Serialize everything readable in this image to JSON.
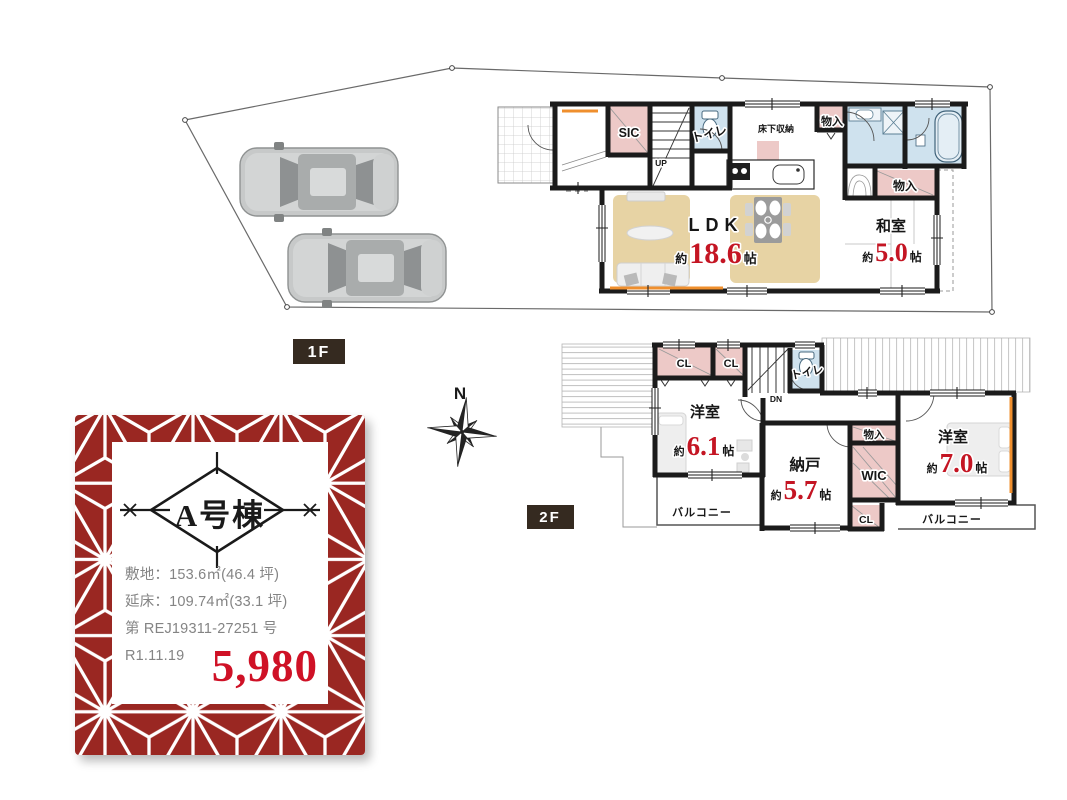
{
  "colors": {
    "wall_black": "#1b1b1b",
    "closet_pink": "#edc9c7",
    "wet_blue": "#cfe2ee",
    "floor_tan": "#e7d3a4",
    "number_red": "#c41523",
    "card_red": "#9a2722",
    "price_red": "#cf1126",
    "tag_brown": "#352a20",
    "accent_orange": "#ef8f2e"
  },
  "compass": {
    "north": "N"
  },
  "floor1": {
    "tag": "1F",
    "ldk": {
      "name": "LDK",
      "approx": "約",
      "size": "18.6",
      "unit": "帖"
    },
    "washitsu": {
      "name": "和室",
      "approx": "約",
      "size": "5.0",
      "unit": "帖"
    },
    "sic": "SIC",
    "toilet": "トイレ",
    "underfloor": "床下収納",
    "closet_a": "物入",
    "closet_b": "物入",
    "stairs": "UP"
  },
  "floor2": {
    "tag": "2F",
    "bedroom1": {
      "name": "洋室",
      "approx": "約",
      "size": "6.1",
      "unit": "帖"
    },
    "storage": {
      "name": "納戸",
      "approx": "約",
      "size": "5.7",
      "unit": "帖"
    },
    "bedroom2": {
      "name": "洋室",
      "approx": "約",
      "size": "7.0",
      "unit": "帖"
    },
    "cl1": "CL",
    "cl2": "CL",
    "cl3": "CL",
    "toilet": "トイレ",
    "closet": "物入",
    "wic": "WIC",
    "balcony_left": "バルコニー",
    "balcony_right": "バルコニー",
    "stairs": "DN"
  },
  "card": {
    "title": "A号棟",
    "site_area": "敷地：153.6㎡(46.4 坪)",
    "floor_area": "延床：109.74㎡(33.1 坪)",
    "license": "第 REJ19311-27251 号",
    "date": "R1.11.19",
    "price": "5,980"
  }
}
